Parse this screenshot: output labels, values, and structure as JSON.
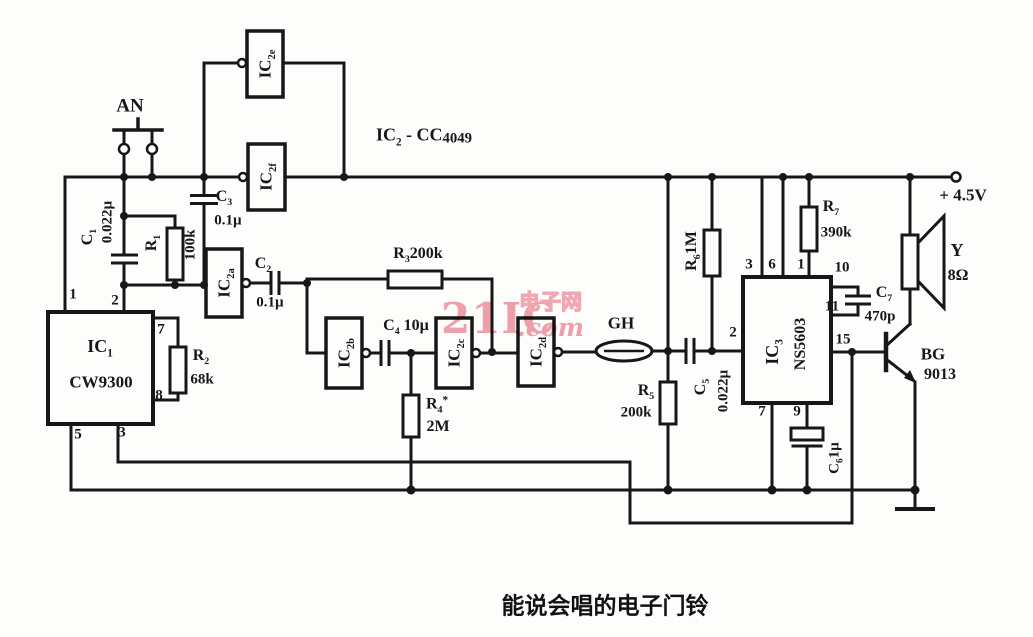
{
  "caption": "能说会唱的电子门铃",
  "watermark": {
    "big": "21IC",
    "cn": "电子网",
    "com": ".com"
  },
  "supply": "+ 4.5V",
  "chip_note": {
    "p1": "IC",
    "s1": "2",
    "p2": " - CC",
    "s2": "4049"
  },
  "labels": {
    "an": "AN",
    "gh": "GH",
    "c1": {
      "ref": "C",
      "refsub": "1",
      "val": "0.022µ"
    },
    "r1": {
      "ref": "R",
      "refsub": "1",
      "val": "100k"
    },
    "c3": {
      "ref": "C",
      "refsub": "3",
      "val": "0.1µ"
    },
    "c2": {
      "ref": "C",
      "refsub": "2",
      "val": "0.1µ"
    },
    "r3": {
      "ref": "R",
      "refsub": "3",
      "val": "200k"
    },
    "ic1": {
      "ref": "IC",
      "refsub": "1",
      "val": "CW9300"
    },
    "r2": {
      "ref": "R",
      "refsub": "2",
      "val": "68k"
    },
    "c4": {
      "ref": "C",
      "refsub": "4",
      "val": "10µ"
    },
    "r4": {
      "ref": "R",
      "refsub": "4",
      "star": "*",
      "val": "2M"
    },
    "r5": {
      "ref": "R",
      "refsub": "5",
      "val": "200k"
    },
    "c5": {
      "ref": "C",
      "refsub": "5",
      "val": "0.022µ"
    },
    "r6": {
      "ref": "R",
      "refsub": "6",
      "val": "1M"
    },
    "ic3": {
      "ref": "IC",
      "refsub": "3",
      "val": "NS5603"
    },
    "r7": {
      "ref": "R",
      "refsub": "7",
      "val": "390k"
    },
    "c7": {
      "ref": "C",
      "refsub": "7",
      "val": "470p"
    },
    "c6": {
      "ref": "C",
      "refsub": "6",
      "val": "1µ"
    },
    "y": {
      "ref": "Y",
      "val": "8Ω"
    },
    "bg": {
      "ref": "BG",
      "val": "9013"
    },
    "ic2a": {
      "ref": "IC",
      "refsub": "2a"
    },
    "ic2b": {
      "ref": "IC",
      "refsub": "2b"
    },
    "ic2c": {
      "ref": "IC",
      "refsub": "2c"
    },
    "ic2d": {
      "ref": "IC",
      "refsub": "2d"
    },
    "ic2e": {
      "ref": "IC",
      "refsub": "2e"
    },
    "ic2f": {
      "ref": "IC",
      "refsub": "2f"
    }
  },
  "ic1_pins": {
    "p1": "1",
    "p2": "2",
    "p3": "3",
    "p5": "5",
    "p7": "7",
    "p8": "8"
  },
  "ic3_pins": {
    "p1": "1",
    "p2": "2",
    "p3": "3",
    "p6": "6",
    "p7": "7",
    "p9": "9",
    "p10": "10",
    "p11": "11",
    "p15": "15"
  }
}
